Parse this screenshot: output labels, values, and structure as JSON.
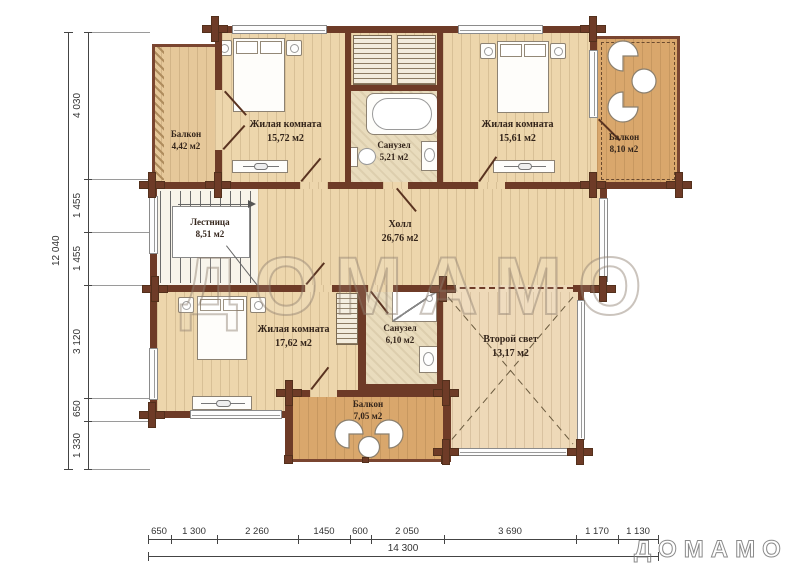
{
  "watermark": {
    "text": "ДОМАМО"
  },
  "rooms": [
    {
      "id": "balcony-top-left",
      "name": "Балкон",
      "area": "4,42 м2"
    },
    {
      "id": "bedroom-top-left",
      "name": "Жилая комната",
      "area": "15,72 м2"
    },
    {
      "id": "bathroom-top",
      "name": "Санузел",
      "area": "5,21 м2"
    },
    {
      "id": "bedroom-top-right",
      "name": "Жилая комната",
      "area": "15,61 м2"
    },
    {
      "id": "balcony-top-right",
      "name": "Балкон",
      "area": "8,10 м2"
    },
    {
      "id": "staircase",
      "name": "Лестница",
      "area": "8,51 м2"
    },
    {
      "id": "hall",
      "name": "Холл",
      "area": "26,76 м2"
    },
    {
      "id": "bedroom-bottom",
      "name": "Жилая комната",
      "area": "17,62 м2"
    },
    {
      "id": "bathroom-bottom",
      "name": "Санузел",
      "area": "6,10 м2"
    },
    {
      "id": "second-light",
      "name": "Второй свет",
      "area": "13,17 м2"
    },
    {
      "id": "balcony-bottom",
      "name": "Балкон",
      "area": "7,05 м2"
    }
  ],
  "dimensions": {
    "left": [
      "4 030",
      "1 455",
      "1 455",
      "3 120",
      "650",
      "1 330"
    ],
    "left_total": "12 040",
    "bottom": [
      "650",
      "1 300",
      "2 260",
      "1450",
      "600",
      "2 050",
      "3 690",
      "1 170",
      "1 130"
    ],
    "bottom_total": "14 300"
  },
  "colors": {
    "wall": "#6e3b27",
    "wood_floor": "#edd6ac",
    "balcony_floor": "#d9a76c",
    "tile_floor": "#e9dcbd"
  }
}
